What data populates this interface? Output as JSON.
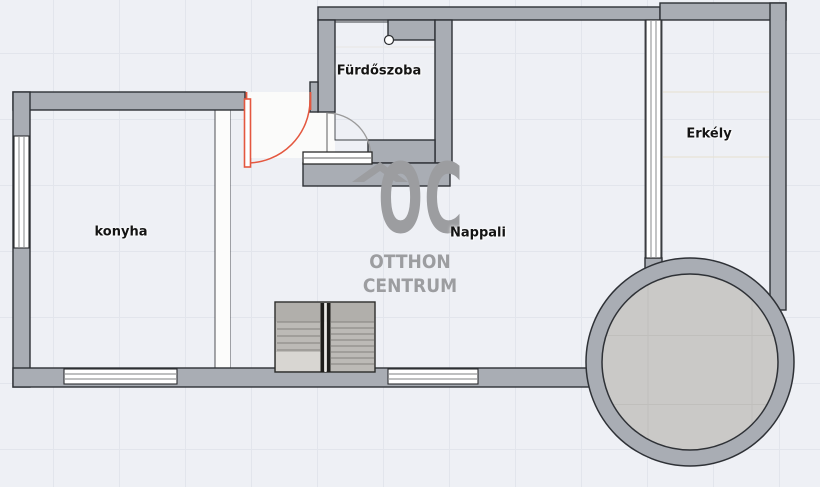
{
  "rooms": [
    {
      "id": "furdoszoba",
      "label": "Fürdőszoba"
    },
    {
      "id": "konyha",
      "label": "konyha"
    },
    {
      "id": "nappali",
      "label": "Nappali"
    },
    {
      "id": "erkely",
      "label": "Erkély"
    }
  ],
  "watermark": {
    "monogram": "OC",
    "line1": "OTTHON",
    "line2": "CENTRUM"
  },
  "colors": {
    "wall": "#a9adb4",
    "outline": "#2e3136",
    "accent": "#e4573f",
    "bg": "#eef0f5",
    "grid": "#e2e5ec",
    "wm": "#9c9da0",
    "label": "#141414",
    "floor-kitchen": "#edeae3",
    "floor-living": "#cac9c7",
    "floor-bathroom": "#f5f4f2",
    "floor-balcony": "#f2efe3"
  }
}
